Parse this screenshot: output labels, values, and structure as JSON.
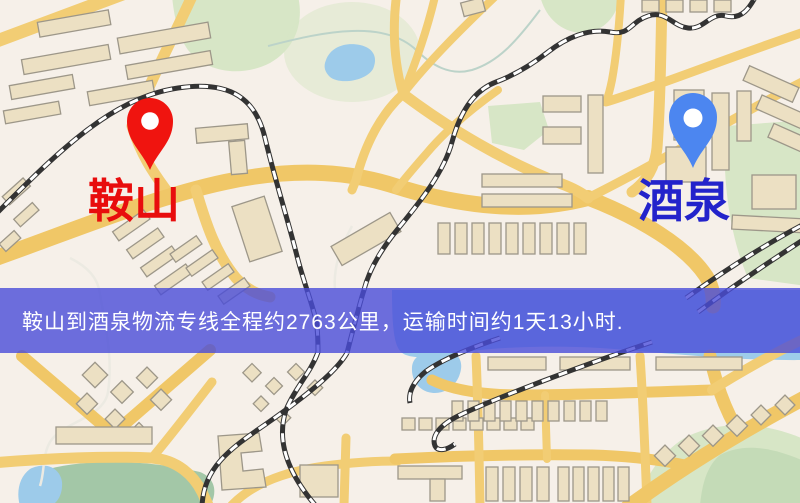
{
  "origin": {
    "label": "鞍山",
    "pin_icon": "map-pin-icon",
    "pin_color": "#f0140f",
    "label_color": "#e80d0d"
  },
  "destination": {
    "label": "酒泉",
    "pin_icon": "map-pin-icon",
    "pin_color": "#4c86f0",
    "label_color": "#2323cb"
  },
  "banner": {
    "text": "鞍山到酒泉物流专线全程约2763公里，运输时间约1天13小时.",
    "background_color": "#4a4cd8",
    "text_color": "#ffffff"
  },
  "map_palette": {
    "background": "#f6f0e9",
    "road": "#f2cd74",
    "building": "#ece0c3",
    "building_outline": "#9d9789",
    "green_area": "#d7e6c6",
    "green_dark": "#a3c7a7",
    "water": "#9dcbea",
    "railway_dark": "#333333",
    "railway_light": "#ffffff"
  }
}
